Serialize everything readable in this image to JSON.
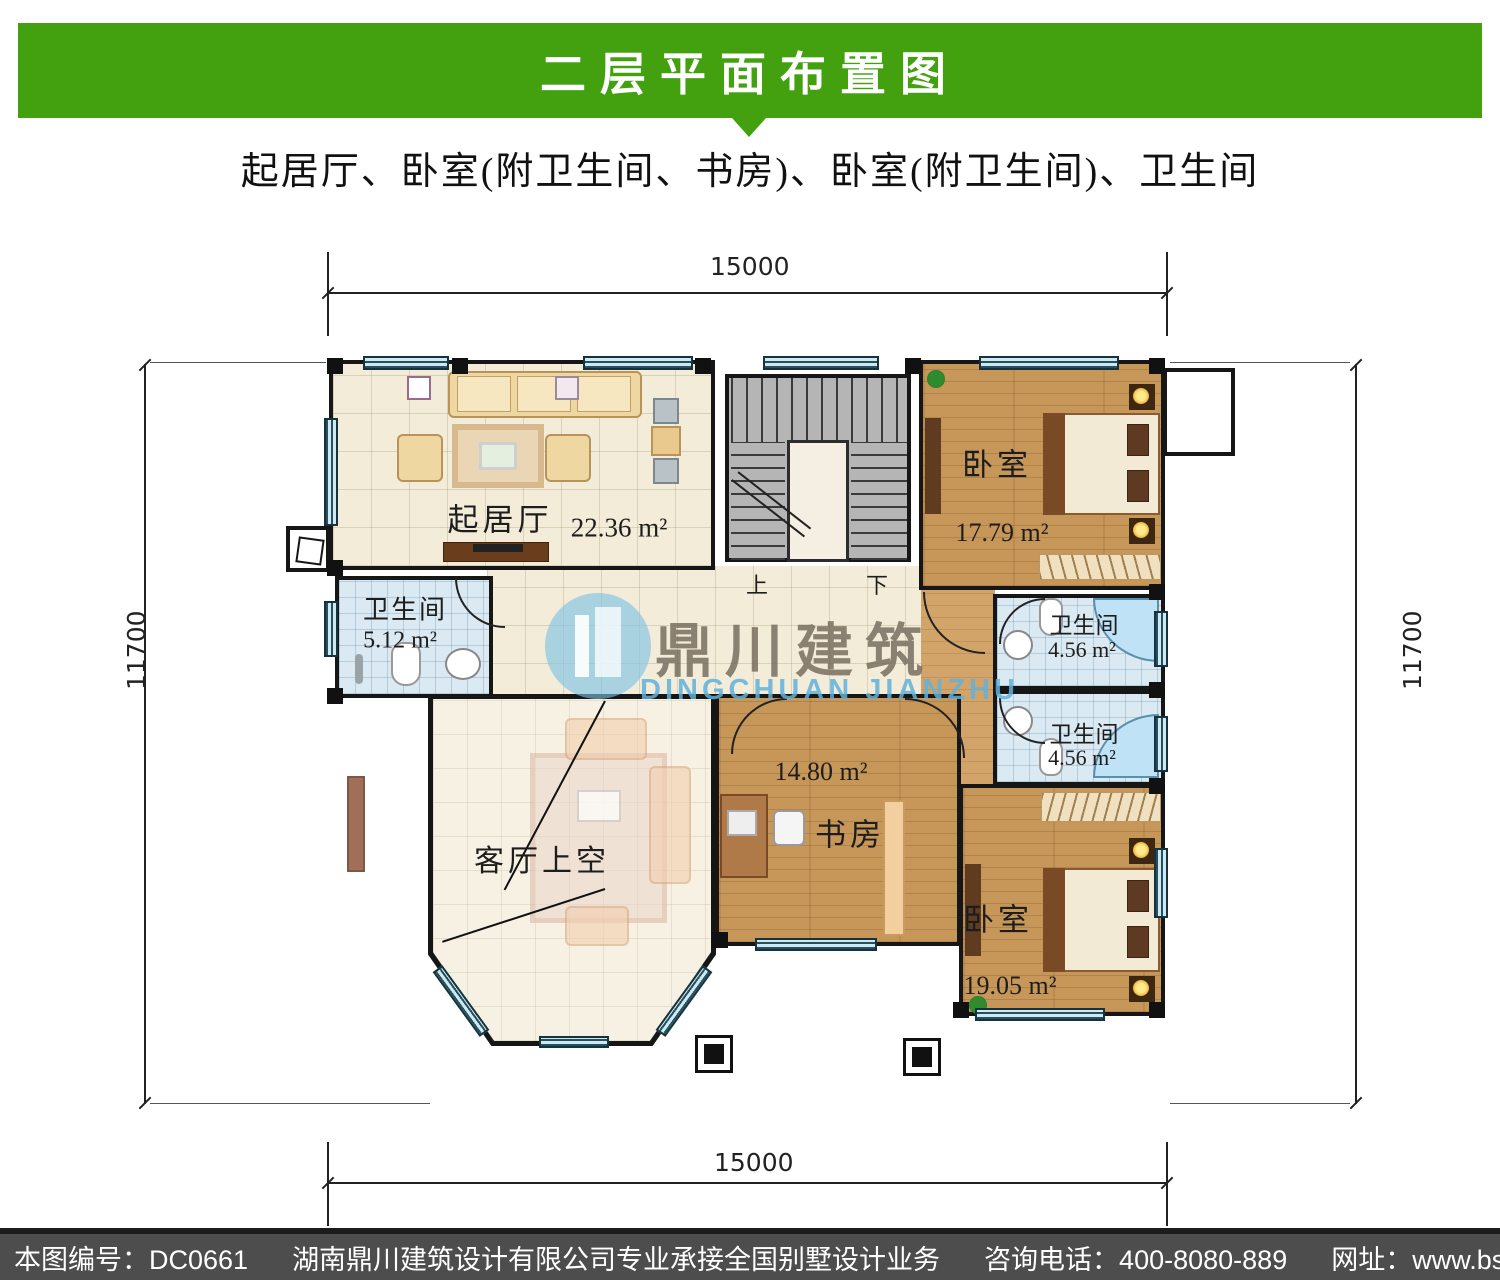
{
  "banner": {
    "title": "二层平面布置图"
  },
  "subtitle": "起居厅、卧室(附卫生间、书房)、卧室(附卫生间)、卫生间",
  "dimensions": {
    "top": "15000",
    "bottom": "15000",
    "left": "11700",
    "right": "11700"
  },
  "stairs": {
    "up": "上",
    "down": "下"
  },
  "rooms": {
    "living_room": {
      "name": "起居厅",
      "area": "22.36 m²"
    },
    "bathroom_left": {
      "name": "卫生间",
      "area": "5.12 m²"
    },
    "bedroom_top_right": {
      "name": "卧室",
      "area": "17.79 m²"
    },
    "bathroom_right_upper": {
      "name": "卫生间",
      "area": "4.56 m²"
    },
    "bathroom_right_lower": {
      "name": "卫生间",
      "area": "4.56 m²"
    },
    "study": {
      "name": "书房",
      "area": "14.80 m²"
    },
    "bedroom_bottom_right": {
      "name": "卧室",
      "area": "19.05 m²"
    },
    "living_void": {
      "name": "客厅上空"
    }
  },
  "watermark": {
    "cn": "鼎川建筑",
    "en": "DINGCHUAN JIANZHU"
  },
  "footer": {
    "plan_number": "本图编号：DC0661",
    "company": "湖南鼎川建筑设计有限公司专业承接全国别墅设计业务",
    "phone": "咨询电话：400-8080-889",
    "website": "网址：www.bstzcs.com"
  },
  "colors": {
    "banner_green": "#43a00e",
    "footer_gray": "#4d4d4d",
    "wood": "#c69758",
    "tile_cream": "#f2ecd9",
    "tile_blue": "#dbe9f2",
    "stair_gray": "#b5b5b5",
    "watermark_blue": "#60b2db"
  }
}
